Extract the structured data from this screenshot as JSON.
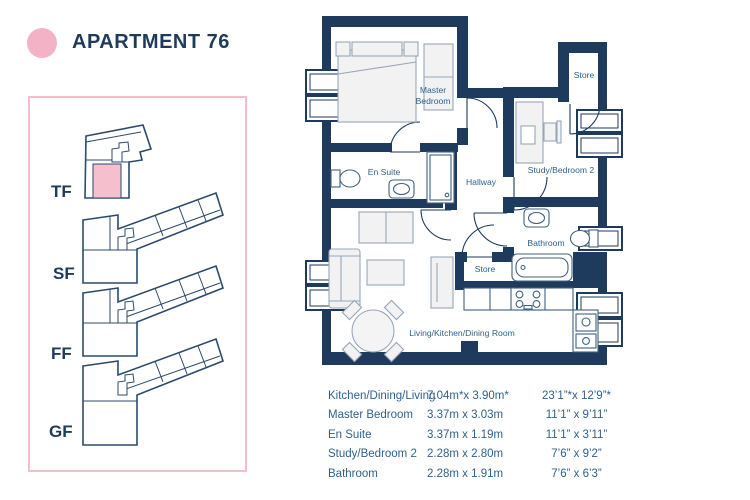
{
  "page": {
    "title": "APARTMENT 76"
  },
  "colors": {
    "navy": "#1e3a5c",
    "label_blue": "#2e618a",
    "table_blue": "#31618a",
    "pink": "#f3b2c5",
    "pink_border": "#f3bdc9",
    "pink_unit": "#f6bfce"
  },
  "floor_selector": {
    "floors": [
      {
        "id": "tf",
        "label": "TF",
        "highlighted": true
      },
      {
        "id": "sf",
        "label": "SF",
        "highlighted": false
      },
      {
        "id": "ff",
        "label": "FF",
        "highlighted": false
      },
      {
        "id": "gf",
        "label": "GF",
        "highlighted": false
      }
    ]
  },
  "plan": {
    "labels": {
      "master_line1": "Master",
      "master_line2": "Bedroom",
      "ensuite": "En Suite",
      "hallway": "Hallway",
      "store_top": "Store",
      "study": "Study/Bedroom 2",
      "bathroom": "Bathroom",
      "store_mid": "Store",
      "living": "Living/Kitchen/Dining Room"
    }
  },
  "dimensions": {
    "rows": [
      {
        "room": "Kitchen/Dining/Living",
        "metric": "7.04m*x 3.90m*",
        "imperial": "23’1”*x 12’9”*"
      },
      {
        "room": "Master Bedroom",
        "metric": "3.37m x 3.03m",
        "imperial": "11’1” x 9’11”"
      },
      {
        "room": "En Suite",
        "metric": "3.37m x 1.19m",
        "imperial": "11’1” x 3’11”"
      },
      {
        "room": "Study/Bedroom 2",
        "metric": "2.28m x 2.80m",
        "imperial": "7’6” x 9’2”"
      },
      {
        "room": "Bathroom",
        "metric": "2.28m x 1.91m",
        "imperial": "7’6” x 6’3”"
      }
    ]
  }
}
